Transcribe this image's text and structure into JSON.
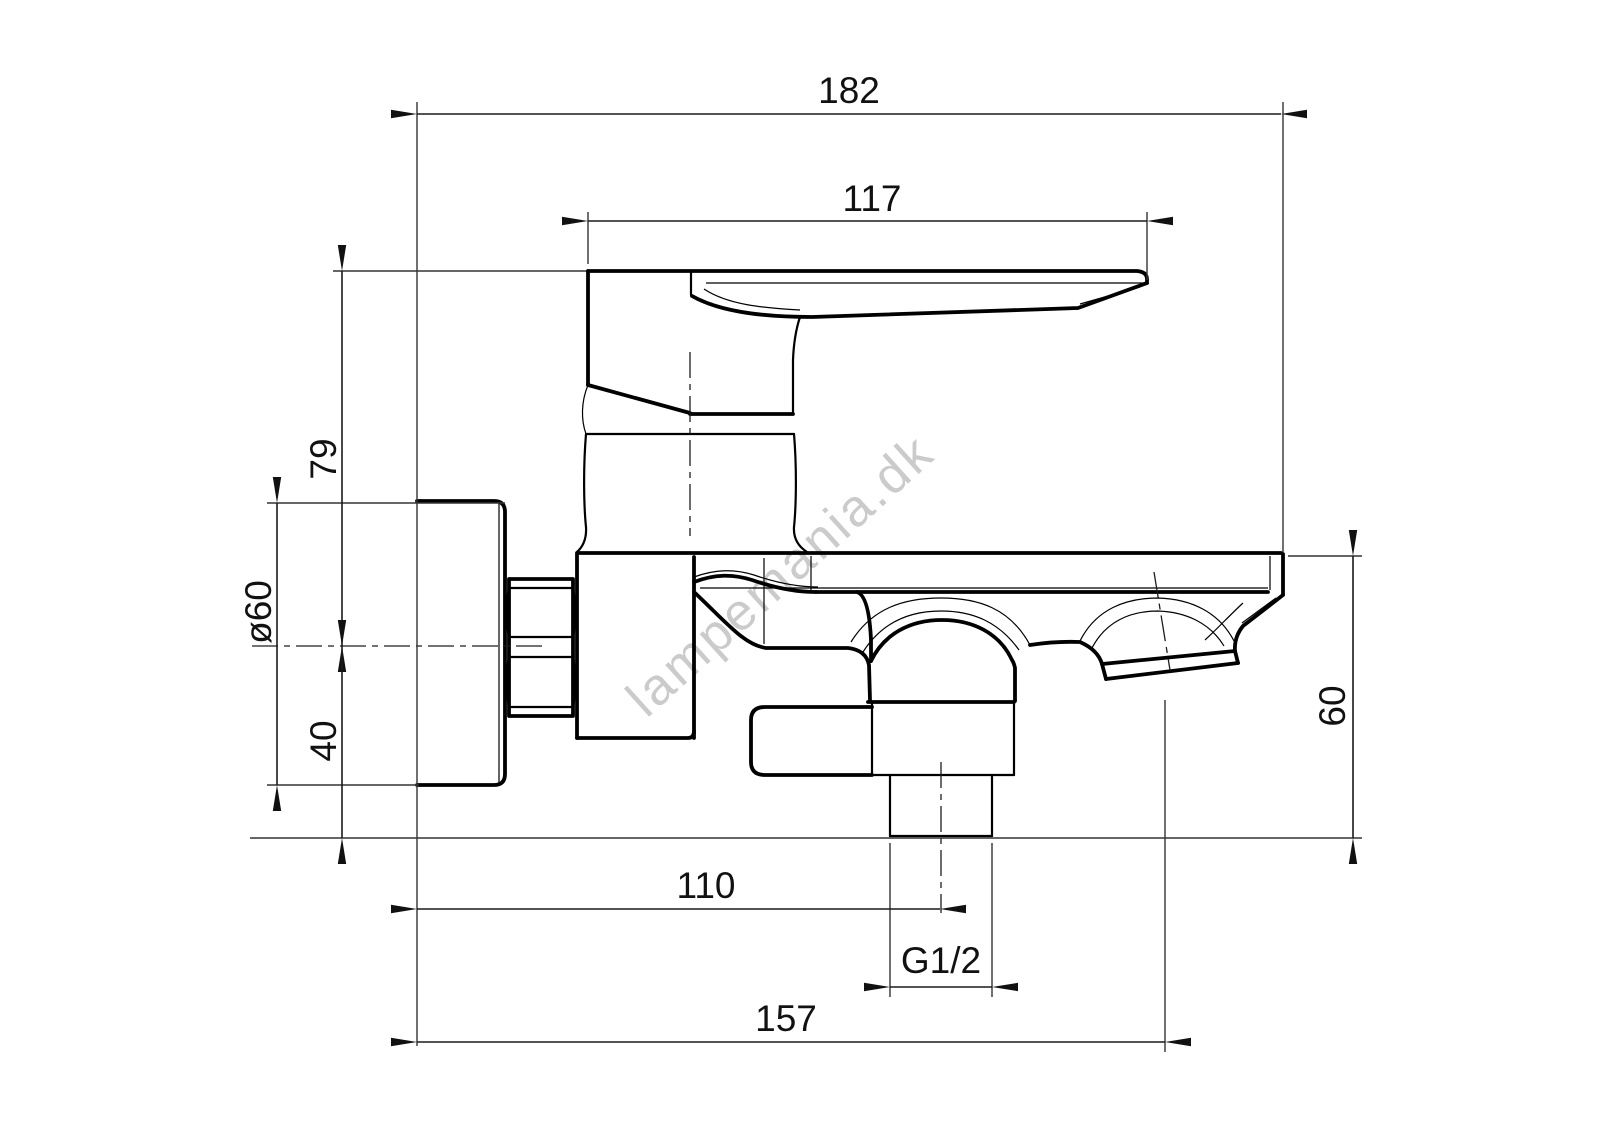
{
  "drawing": {
    "watermark": "lampemania.dk",
    "background_color": "#ffffff",
    "line_color": "#000000",
    "watermark_color": "#c3c3c3",
    "dimensions": [
      {
        "id": "total-width",
        "label": "182",
        "orientation": "horizontal"
      },
      {
        "id": "lever-length",
        "label": "117",
        "orientation": "horizontal"
      },
      {
        "id": "height-above-axis",
        "label": "79",
        "orientation": "vertical"
      },
      {
        "id": "flange-diameter",
        "label": "ø60",
        "orientation": "vertical"
      },
      {
        "id": "axis-to-outlet",
        "label": "40",
        "orientation": "vertical"
      },
      {
        "id": "spout-end-height",
        "label": "60",
        "orientation": "vertical"
      },
      {
        "id": "wall-to-outlet-axis",
        "label": "110",
        "orientation": "horizontal"
      },
      {
        "id": "outlet-thread",
        "label": "G1/2",
        "orientation": "horizontal"
      },
      {
        "id": "wall-to-spout-axis",
        "label": "157",
        "orientation": "horizontal"
      }
    ]
  }
}
